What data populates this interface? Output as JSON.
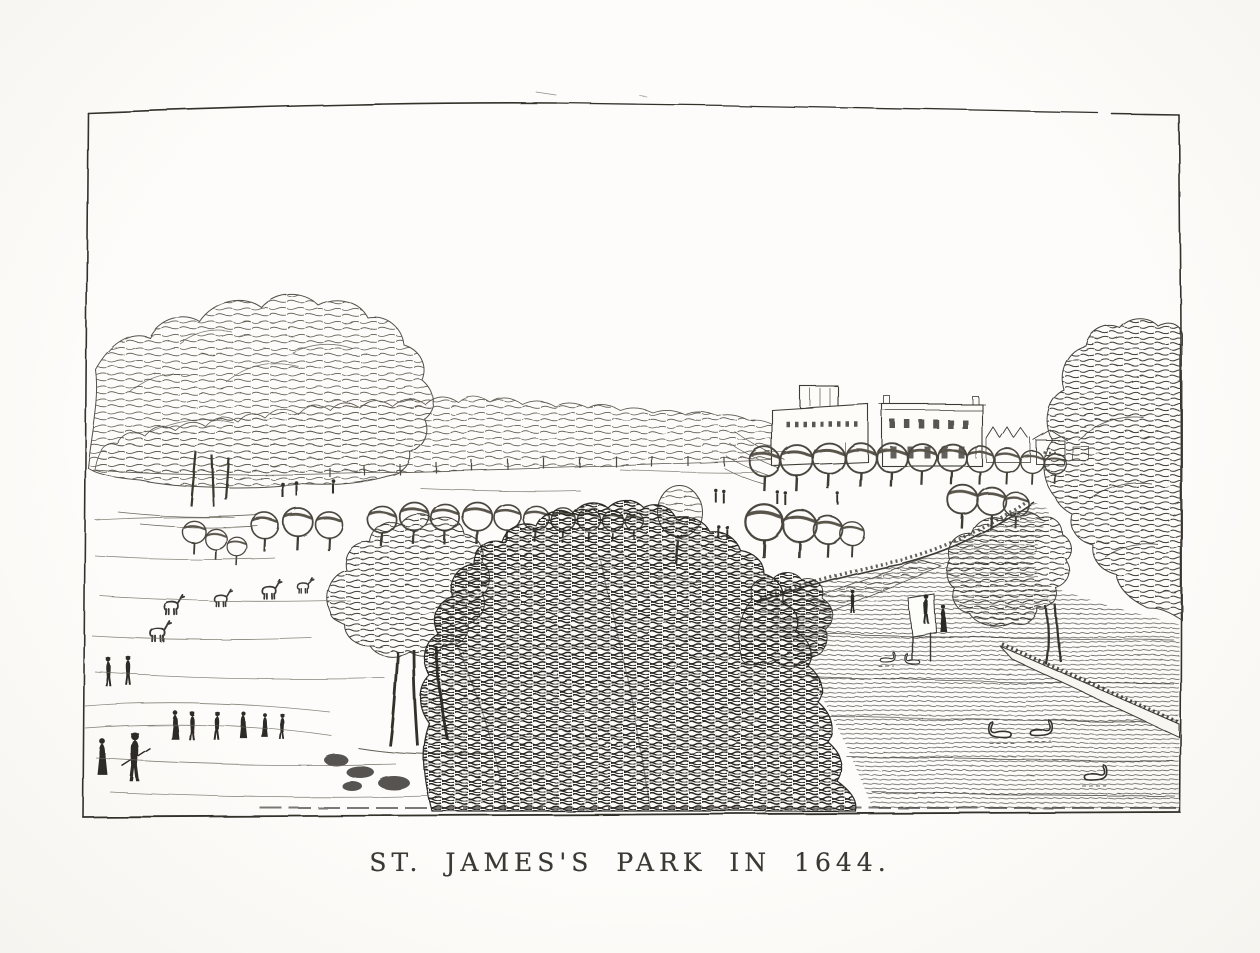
{
  "page": {
    "kind": "scanned book plate",
    "paper_color": "#fbfaf7",
    "ink_color": "#2f2d29"
  },
  "plate": {
    "medium": "line engraving",
    "caption": "ST. JAMES'S PARK IN 1644.",
    "border": "thin irregular rectangular rule",
    "scene": {
      "subject": "View across St. James's Park with lake, avenues of trees and distant buildings",
      "sky": "blank paper",
      "buildings": [
        "long building with square tower",
        "two-storey mansion with rows of windows",
        "row of small gabled houses"
      ],
      "trees": [
        "large sketchy tree group at left",
        "distant treeline across horizon",
        "avenues of round clipped trees",
        "dense dark central tree mass",
        "tall tree against right border",
        "tree leaning over the lake bank"
      ],
      "water": "lake at right rendered with horizontal ruled lines",
      "people": {
        "foreground_walkers": 8,
        "pair_on_upper_path": 2,
        "distant_strollers": 9,
        "figures_at_pond_edge": 3
      },
      "animals": {
        "swans_on_lake": 5,
        "deer_grazing": 5
      }
    }
  }
}
